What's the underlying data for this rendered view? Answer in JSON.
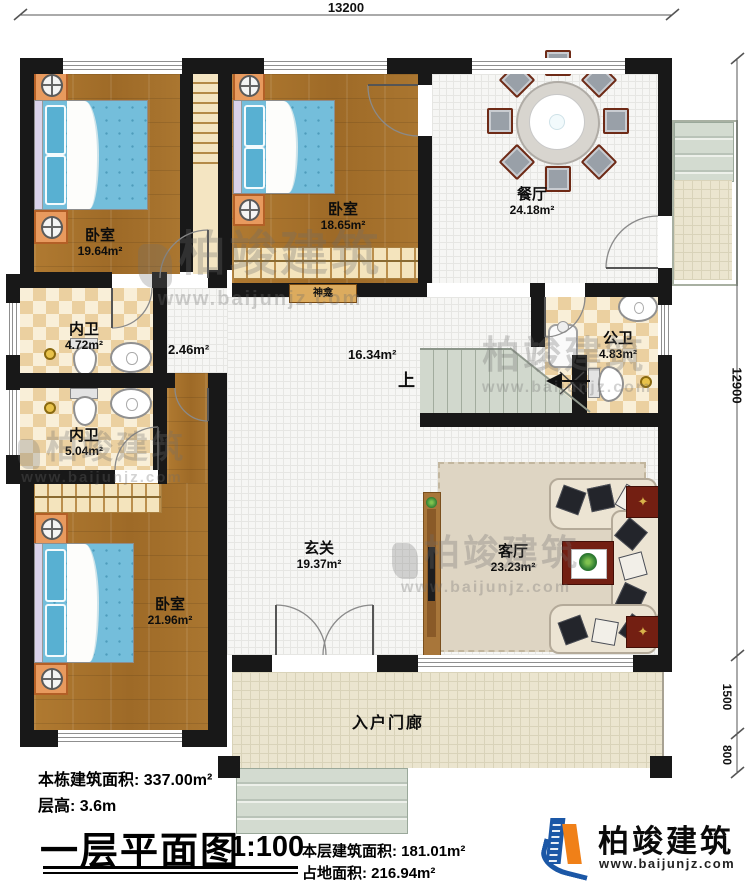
{
  "dimensions": {
    "top_width": "13200",
    "right_main": "12900",
    "right_porch": "1500",
    "right_steps": "800"
  },
  "rooms": {
    "bedroom1": {
      "name": "卧室",
      "area": "19.64m²"
    },
    "bedroom2": {
      "name": "卧室",
      "area": "18.65m²"
    },
    "bedroom3": {
      "name": "卧室",
      "area": "21.96m²"
    },
    "dining": {
      "name": "餐厅",
      "area": "24.18m²"
    },
    "bath1": {
      "name": "内卫",
      "area": "4.72m²"
    },
    "bath2": {
      "name": "内卫",
      "area": "5.04m²"
    },
    "public_bath": {
      "name": "公卫",
      "area": "4.83m²"
    },
    "foyer": {
      "name": "玄关",
      "area": "19.37m²"
    },
    "living": {
      "name": "客厅",
      "area": "23.23m²"
    },
    "porch": {
      "name": "入户门廊"
    },
    "hall_small_area": "2.46m²",
    "hall_mid_area": "16.34m²",
    "shrine": "神龛",
    "stair_up": "上"
  },
  "title_block": {
    "building_total_area": "本栋建筑面积: 337.00m²",
    "floor_height": "层高: 3.6m",
    "plan_title": "一层平面图",
    "scale": "1:100",
    "floor_area": "本层建筑面积: 181.01m²",
    "footprint_area": "占地面积: 216.94m²"
  },
  "logo": {
    "name": "柏竣建筑",
    "url": "www.baijunjz.com"
  },
  "watermark": {
    "name": "柏竣建筑",
    "url": "www.baijunjz.com"
  }
}
